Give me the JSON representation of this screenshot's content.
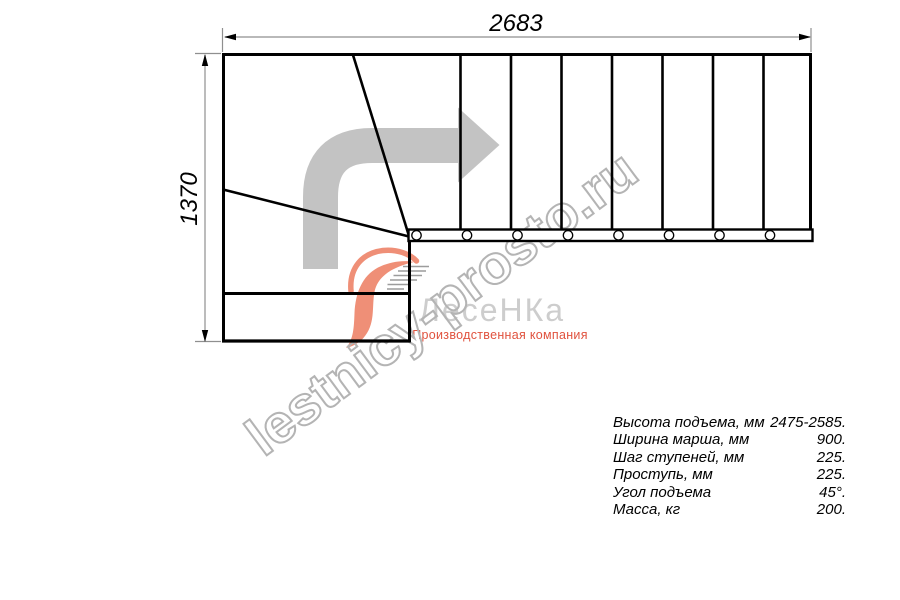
{
  "drawing": {
    "type": "staircase-floor-plan",
    "width_label": "2683",
    "height_label": "1370",
    "straight_treads": 8,
    "winder_treads": 3,
    "mount_holes": 8,
    "direction_arrow": "up-then-right-turn"
  },
  "watermark": {
    "text": "lestnicy-prosto.ru",
    "color": "#b4b4b4"
  },
  "logo": {
    "name": "ЛесеНКа",
    "subtitle": "Производственная компания",
    "name_color": "#cdcdcd",
    "subtitle_color": "#e0523e",
    "mark_color": "#ef8f77"
  },
  "specs": {
    "rows": [
      {
        "label": "Высота подъема, мм",
        "value": "2475-2585."
      },
      {
        "label": "Ширина марша, мм",
        "value": "900."
      },
      {
        "label": "Шаг ступеней, мм",
        "value": "225."
      },
      {
        "label": "Проступь, мм",
        "value": "225."
      },
      {
        "label": "Угол подъема",
        "value": "45°."
      },
      {
        "label": "Масса, кг",
        "value": "200."
      }
    ]
  },
  "colors": {
    "line": "#000000",
    "dimension": "#8f8f8f",
    "arrow_gray": "#c3c3c3"
  }
}
